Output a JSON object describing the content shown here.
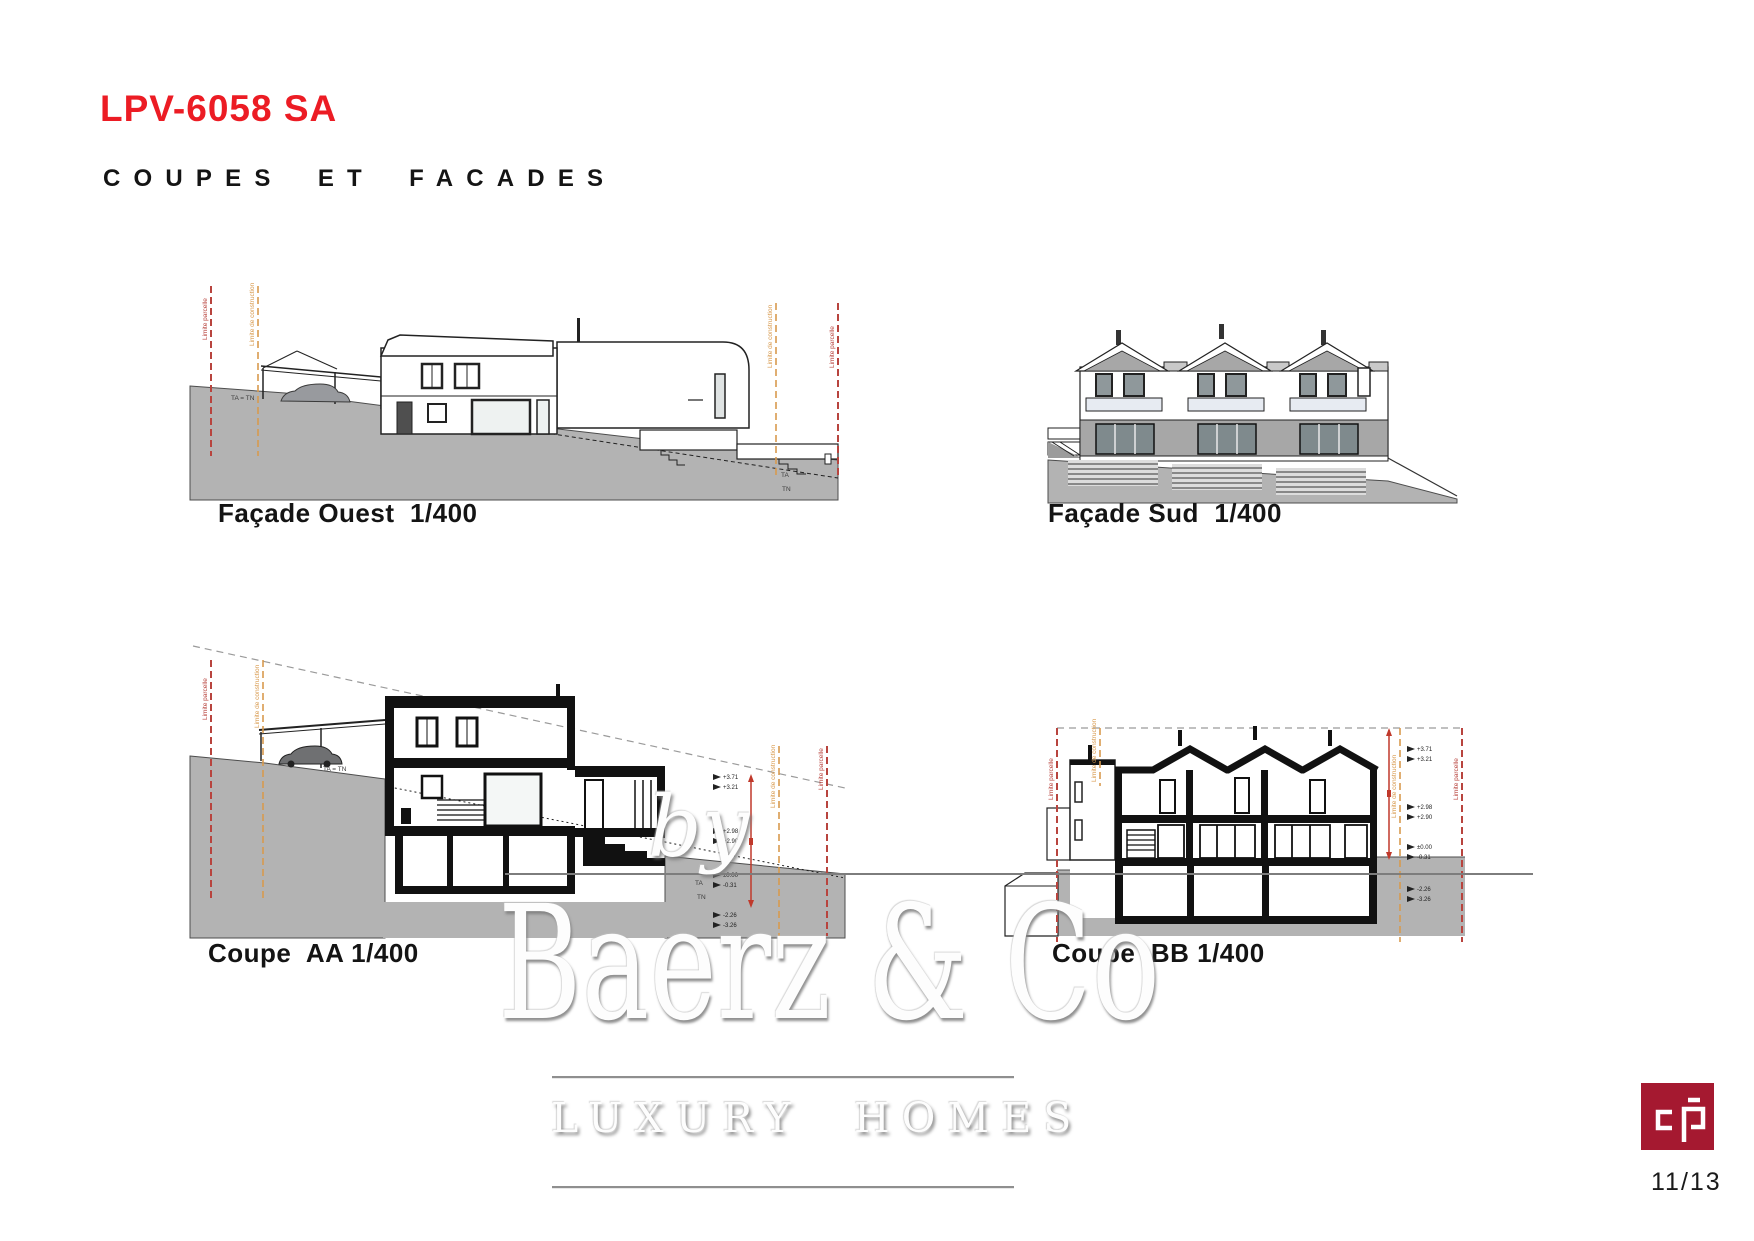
{
  "header": {
    "title": "LPV-6058 SA",
    "subtitle": "COUPES ET FACADES"
  },
  "drawings": {
    "facade_ouest": {
      "caption": "Façade Ouest  1/400"
    },
    "facade_sud": {
      "caption": "Façade Sud  1/400"
    },
    "coupe_aa": {
      "caption": "Coupe  AA 1/400"
    },
    "coupe_bb": {
      "caption": "Coupe  BB 1/400"
    }
  },
  "annotations": {
    "limit_parcel": "Limite parcelle",
    "limit_construction": "Limite de construction",
    "ta_tn": "TA = TN",
    "ta": "TA",
    "tn": "TN",
    "levels": [
      "+3.71",
      "+3.21",
      "+2.98",
      "+2.90",
      "±0.00",
      "-0.31",
      "-2.26",
      "-3.26"
    ]
  },
  "watermark": {
    "by": "by",
    "name": "Baerz & Co",
    "tagline": "LUXURY HOMES"
  },
  "footer": {
    "page_number": "11/13",
    "logo": "cp-monogram"
  },
  "colors": {
    "accent_red": "#ec1c24",
    "logo_red": "#a51930",
    "limit_parcel_red": "#b8443e",
    "limit_construction_orange": "#d89a4e",
    "terrain_gray": "#b3b3b3",
    "drawing_black": "#1a1a1a"
  }
}
